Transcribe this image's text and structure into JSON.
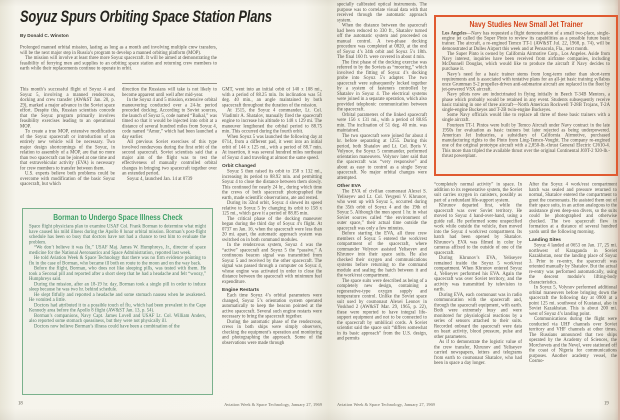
{
  "spread": {
    "publication_folio": "Aviation Week & Space Technology, January 27, 1969"
  },
  "colors": {
    "paper": "#f7f5ed",
    "body_text": "#514f46",
    "headline_text": "#26251f",
    "navy_box_border": "#e05a30",
    "navy_box_title": "#d4461c",
    "borman_box_border": "#7ab18c",
    "borman_box_title": "#3da167",
    "borman_box_text": "#4e7463"
  },
  "page_left": {
    "page_number": "18",
    "headline": "Soyuz Spurs Orbiting Space Station Plans",
    "byline": "By Donald C. Winston",
    "lead": [
      {
        "p": "Prolonged manned orbital mission, lasting as long as a month and involving multiple crew transfers, will be the next major step in Russia’s program to develop a manned orbiting platform (MOP)."
      },
      {
        "p": "The mission will involve at least three more Soyuz spacecraft. It will be aimed at demonstrating the feasibility of ferrying men and supplies to an orbiting space station and returning crew members to earth while their replacements continue to operate in orbit."
      }
    ],
    "col1": [
      {
        "p": "This month’s successful flight of Soyuz 4 and Soyuz 5, involving a manned rendezvous, docking and crew transfer (AW&ST Jan. 20, p. 29), marked a major advance in the Soviet space effort. Despite this, Russian scientists concede that the Soyuz program primarily involves feasibility exercises leading to an operational MOP."
      },
      {
        "p": "To create a true MOP, extensive modification of the Soyuz spacecraft or introduction of an entirely new vehicle will be necessary. Two major design shortcomings of the Soyuz, in relation to assembly of a MOP, are that no more than two spacecraft can be joined at one time and that extravehicular activity (EVA) is necessary for crew members to transfer between them."
      },
      {
        "p": "U.S. experts believe both problems could be overcome with modification of the basic Soyuz spacecraft, but which"
      }
    ],
    "col2": [
      {
        "p": "direction the Russians will take is not likely to become apparent until well after mid-year."
      },
      {
        "p": "In the Soyuz 4 and 5 mission, extensive orbital maneuvering conducted over a 24-hr. period preceded docking. According to Soviet sources, the launch of Soyuz 5, code named “Baikal,” was timed so that it would be injected into orbit at a distance of several hundred miles from Soyuz 4, code named “Amur,” which had been launched a day earlier."
      },
      {
        "p": "All previous Soviet exercises of this type involved rendezvous during the first orbit of the second spacecraft. Soviet scientists said that a major aim of the flight was to test the effectiveness of manually controlled orbital changes in bringing two spacecraft together over an extended period."
      },
      {
        "p": "Soyuz 4, launched Jan. 14 at 0739"
      }
    ],
    "col3": [
      {
        "p": "GMT, went into an initial orbit of 140 x 108 mi., with a period of 88.25 min. Its inclination was 51 deg. 40 min., an angle maintained by both spacecraft throughout the duration of the mission."
      },
      {
        "p": "At 1515, the Soyuz 4 commander, Lt. Col. Vladimir A. Shatalov, manually fired the spacecraft engine to increase his altitude to 148 x 129 mi. The maneuver lengthened the orbital period to 88.75 min. This occurred during the fourth orbit."
      },
      {
        "p": "When Soyuz 5 was launched the following day at 0714, from a different pad, it went into an initial orbit of 144 x 125 mi., with a period of 88.7 min. At insertion, it was several hundred miles northeast of Soyuz 4 and traveling at almost the same speed."
      },
      {
        "h": "Orbit Changed"
      },
      {
        "p": "Soyuz 5 then raised its orbit to 158 x 132 mi., increasing its period to 88.92 min. and permitting Soyuz 4 to close the distance between them slowly. This continued for nearly 24 hr., during which time the crews of both spacecraft photographed the earth, made scientific observations, ate and rested."
      },
      {
        "p": "During its 32nd orbit, Soyuz 4 slowed its speed relative to Soyuz 5 by changing its orbit to 158 x 125 mi., which gave it a period of 88.85 min."
      },
      {
        "p": "The critical phase of the docking maneuver began during the third day of Soyuz 4’s flight. At 0737 on Jan. 16, when the spacecraft were less than 20 mi. apart, the automatic approach system was switched on in both command modules."
      },
      {
        "p": "In the rendezvous system, Soyuz 4 was the “active” spacecraft and Soyuz 5 the “passive.” A continuous beacon signal was transmitted from Soyuz 5 and received by the other spacecraft. The signal was passed through a computer on Soyuz 4, whose engine was activated in order to close the distance between the spacecraft with minimum fuel expenditure."
      },
      {
        "h": "Engine Restarts"
      },
      {
        "p": "Each time Soyuz 4’s orbital parameters were changed, Soyuz 5’s orientation system operated automatically to keep the beacon pointed at the active spacecraft. Several such engine restarts were necessary to bring the spacecraft together."
      },
      {
        "p": "During the automatic phase of the rendezvous, crews in both ships were simply observers, checking the equipment’s operation and monitoring and photographing the approach. Some of the observations were made through"
      }
    ],
    "borman_box": {
      "title": "Borman to Undergo Space Illness Check",
      "blocks": [
        {
          "p": "Space flight physicians plan to examine USAF Col. Frank Borman to determine what might have caused his mild illness during the Apollo 8 lunar orbital mission. Borman’s post-flight schedule has been so busy that doctors have not had a chance to test him to evaluate the problem."
        },
        {
          "p": "“We don’t believe it was flu,” USAF Maj. James W. Humphreys, Jr., director of space medicine for the National Aeronautics and Space Administration, reported last week."
        },
        {
          "p": "He told Aviation Week & Space Technology that there was no firm evidence pointing to flu in the case of Borman, who became ill both en route to the moon and on the way back."
        },
        {
          "p": "Before the flight, Borman, who does not like sleeping pills, was tested with them. He took a Seconal pill and reported after a short sleep that he had a headache and felt “woozy,” Humphreys said."
        },
        {
          "p": "During the mission, after an 18-19 hr. day, Borman took a single pill in order to induce sleep because he was two hr. behind schedule."
        },
        {
          "p": "He slept fitfully and reported a headache and some stomach nausea when he awakened. He vomited a little."
        },
        {
          "p": "Doctors had attributed it to a possible touch of flu, which had been prevalent in the Cape Kennedy area before the Apollo 8 flight (AW&ST Jan. 13, p. 54)."
        },
        {
          "p": "Borman’s companions, Navy Capt. James Lovell and USAF Lt. Col. William Anders, also reported some stomach queasiness, but they were not physically ill."
        },
        {
          "p": "Doctors now believe Borman’s illness could have been a combination of the"
        }
      ]
    }
  },
  "page_right": {
    "page_number": "19",
    "col1": [
      {
        "p": "specially calibrated optical instruments. The purpose was to correlate visual data with that received through the automatic approach system."
      },
      {
        "p": "When the distance between the spacecraft had been reduced to 330 ft., Shatalov turned off the automatic system and proceeded on manual control. A two-phase docking procedure was completed at 0820, at the end of Soyuz 4’s 34th orbit and Soyuz 5’s 18th. The final 160 ft. were covered in about 4 min."
      },
      {
        "p": "The first phase of the docking exercise was referred to by the Soviets as “mooring,” which involved the fitting of Soyuz 4’s docking probe into Soyuz 5’s adapter. The two spacecraft were subsequently locked together by a system of fasteners controlled by Shatalov in Soyuz 4. The electrical systems were joined in a separate operation, which also provided telephonic communication between the spacecraft."
      },
      {
        "p": "Orbital parameters of the linked spacecraft were 156 x 131 mi., with a period of 88.85 min. The inclination of 51 deg. 40 min. was maintained."
      },
      {
        "p": "The two spacecraft were joined for about 4 hr. before separating at 1255. During this period, both Shatalov and Lt. Col. Boris V. Volynov, the Soyuz 5 commander, performed orientation maneuvers. Volynov later said that the spacecraft was “very responsive” and about as easy to control as a single Soyuz spacecraft. No major orbital changes were attempted."
      },
      {
        "h": "Other EVA"
      },
      {
        "p": "The EVA of civilian cosmonaut Alexei S. Yeliseyev and Lt. Col. Yevgeni V. Khrunov, who went up with Soyuz 5, occurred during the 35th orbit of Soyuz 4 and the 19th of Soyuz 5. Although the men spent 1 hr. in what Soviet sources called “the environment of outer space,” their actual time outside the spacecraft was only a few minutes."
      },
      {
        "p": "Before starting the EVA, all three crew members of Soyuz 5 entered the work/rest compartment of the spacecraft, where commander Volynov assisted Yeliseyev and Khrunov into their space suits. He also checked their oxygen and communications systems before returning to the command module and sealing the hatch between it and the work/rest compartment."
      },
      {
        "p": "The space suits were described as being of a completely new design, containing a regenerative-type oxygen supply and temperature control. Unlike the Soviet space suit used by cosmonaut Alexei Leonov in Voskhod 2 (AW&ST Mar. 29, 1965, p. 22), these were reported to have integral life-support equipment and not to be connected to the spacecraft by umbilical cords. A Soviet scientist said the space suit “differs somewhat in its basic approach” from the U.S. design, and permits"
      }
    ],
    "navy_box": {
      "title": "Navy Studies New Small Jet Trainer",
      "dateline": "Los Angeles",
      "lead_rest": "—Navy has requested a flight demonstration of a small two-place, single-engine jet called the Super Pinto to review its capabilities as a possible future basic trainer. The aircraft, a re-engined Temco TT-1 (AW&ST Jul. 22, 1968, p. 74), will be demonstrated at Dulles Airport this week and at Pensacola, Fla., next month.",
      "blocks": [
        {
          "p": "The Super Pinto is owned by California Airmotive Corp., Los Angeles. Aside from Navy interest, inquiries have been received from airframe companies, including McDonnell Douglas, which would like to produce the aircraft if Navy decides to purchase it."
        },
        {
          "p": "Navy’s need for a basic trainer stems from long-term rather than short-term requirements and is associated with tentative plans for an all-jet basic training syllabus once Grumman S-2 propeller-driven anti-submarine aircraft are replaced in the fleet by jet-powered VSX aircraft."
        },
        {
          "p": "Navy pilots now are indoctrinated in flying initially in Beech T-34B Mentors, a phase which probably would be retained in any event. Students subsequently receive basic training in one of three aircraft—North American Rockwell T-28B Trojans, T-2A single-engine Buckeyes and T-2B twin-engine Buckeyes."
        },
        {
          "p": "Some Navy officials would like to replace all three of these basic trainers with a single aircraft."
        },
        {
          "p": "Fourteen TT-1 Pintos were built by Temco Aircraft under Navy contract in the late 1950s for evaluation as basic trainers but later rejected as being underpowered. American Jet Industries, a subsidiary of California Airmotive, purchased manufacturing rights to the Pinto from Ling-Temco-Vought. The company re-engined one of the original prototype aircraft with a 2,850-lb.-thrust General Electric CJ610-4. This more than tripled the available thrust over the original Continental J69T-2 920-lb.-thrust powerplant."
        }
      ]
    },
    "col2": [
      {
        "p": "“completely normal activity” in space. In addition to its regenerative system, the Soviet suit carries oxygen in canisters, possibly as part of a redundant life-support system."
      },
      {
        "p": "Khrunov departed first, while the spacecraft was over Soviet territory. He moved to Soyuz 4 hand-over-hand, using a guide rail. He performed some unspecified work while outside the vehicle, then moved into the Soyuz 4 work/rest compartment. Its hatch had been opened by Shatalov. Khrunov’s EVA was filmed in color by cameras affixed to the outside of one of the spacecraft."
      },
      {
        "p": "During Khrunov’s EVA, Yeliseyev remained inside the Soyuz 5 work/rest compartment. When Khrunov entered Soyuz 4, Yeliseyev performed his EVA. Again the spacecraft was over Soviet territory, and the activity was transmitted by television to earth."
      },
      {
        "p": "During EVA, each cosmonaut was in radio communication with the spacecraft and, through the spacecraft equipment, with earth. Both were extremely busy and were monitored for physiological reactions by a series of sensors attached to their suits. Recorded onboard the spacecraft were data on heart activity, blood pressure, pulse and other parameters."
      },
      {
        "p": "As if to demonstrate the logistic value of the crew transfer, Khrunov and Yeliseyev carried newspapers, letters and telegrams from earth to cosmonaut Shatalov, who had been in space a day longer."
      }
    ],
    "col3": [
      {
        "p": "After the Soyuz 4 work/rest compartment hatch was sealed and pressure returned to normal, Shatalov entered the compartment to greet the cosmonauts. He assisted them out of their space suits, in an action analogous to the assistance given deep-sea divers, so the suits could be photographed and otherwise checked. The two spacecraft flew in formation at a distance of several hundred yards until the following morning."
      },
      {
        "h": "Landing Sites"
      },
      {
        "p": "Soyuz 4 landed at 0653 on Jan. 17, 25 mi. northwest of Karaganda in Soviet Kazakhstan, near the landing place of Soyuz 3. Prior to re-entry, the spacecraft was oriented manually by Shatalov. But the actual re-entry was performed automatically, using the descent module’s lifting-body characteristics."
      },
      {
        "p": "In Soyuz 5, Volynov performed additional orbital maneuvers before bringing down the spacecraft the following day at 0900 at a point 125 mi. southwest of Kustanai, also in Soviet Kazakhstan. This is about 200 mi. west of Soyuz 4’s landing point."
      },
      {
        "p": "Communications during the flight were conducted via UHF channels over Soviet territory and VHF channels at other times. The Russians announced that two ships operated by the Academy of Sciences, the Morchovets and the Nevel, were stationed off the coast of Nigeria for communications purposes. Another academy vessel, the Cosmo-"
      }
    ]
  }
}
